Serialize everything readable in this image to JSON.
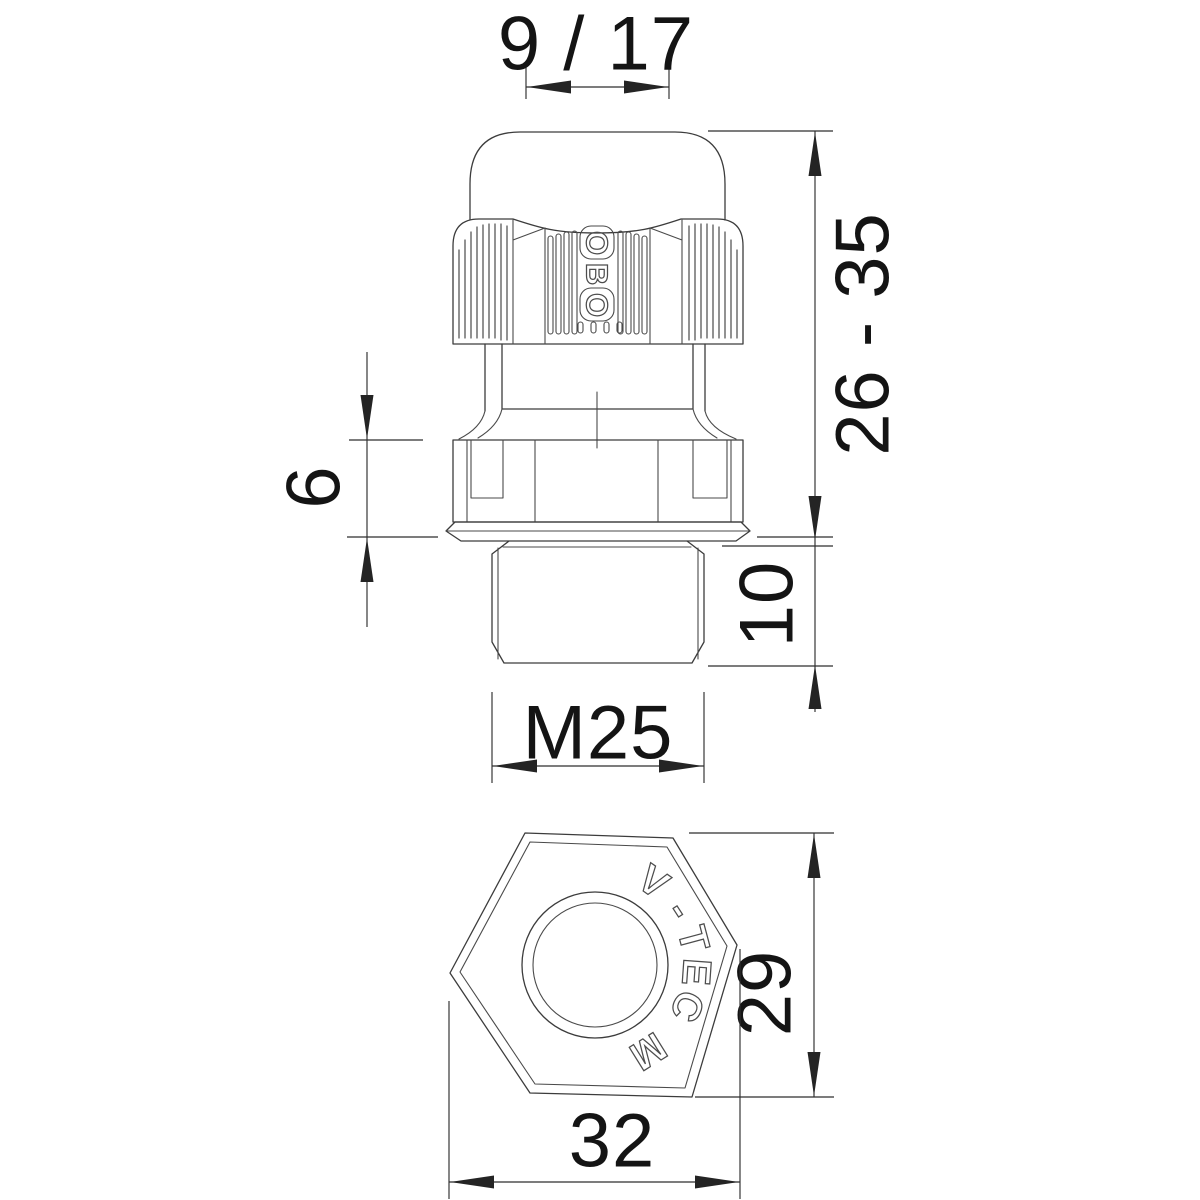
{
  "drawing": {
    "kind": "cable-gland dimensional drawing",
    "colors": {
      "line": "#3c3c3c",
      "text": "#141414",
      "background": "#ffffff"
    },
    "side_view": {
      "brand_letters": [
        "O",
        "B",
        "O"
      ],
      "dims": {
        "clamping_range": "9 / 17",
        "height_range": "26 - 35",
        "collar_height": "6",
        "thread_length": "10",
        "thread_size": "M25"
      }
    },
    "bottom_view": {
      "engraving_letters": [
        "V",
        "-",
        "T",
        "E",
        "C",
        "M"
      ],
      "engraving_text": "V-TEC M",
      "dims": {
        "height_across": "29",
        "width_across": "32"
      }
    }
  }
}
